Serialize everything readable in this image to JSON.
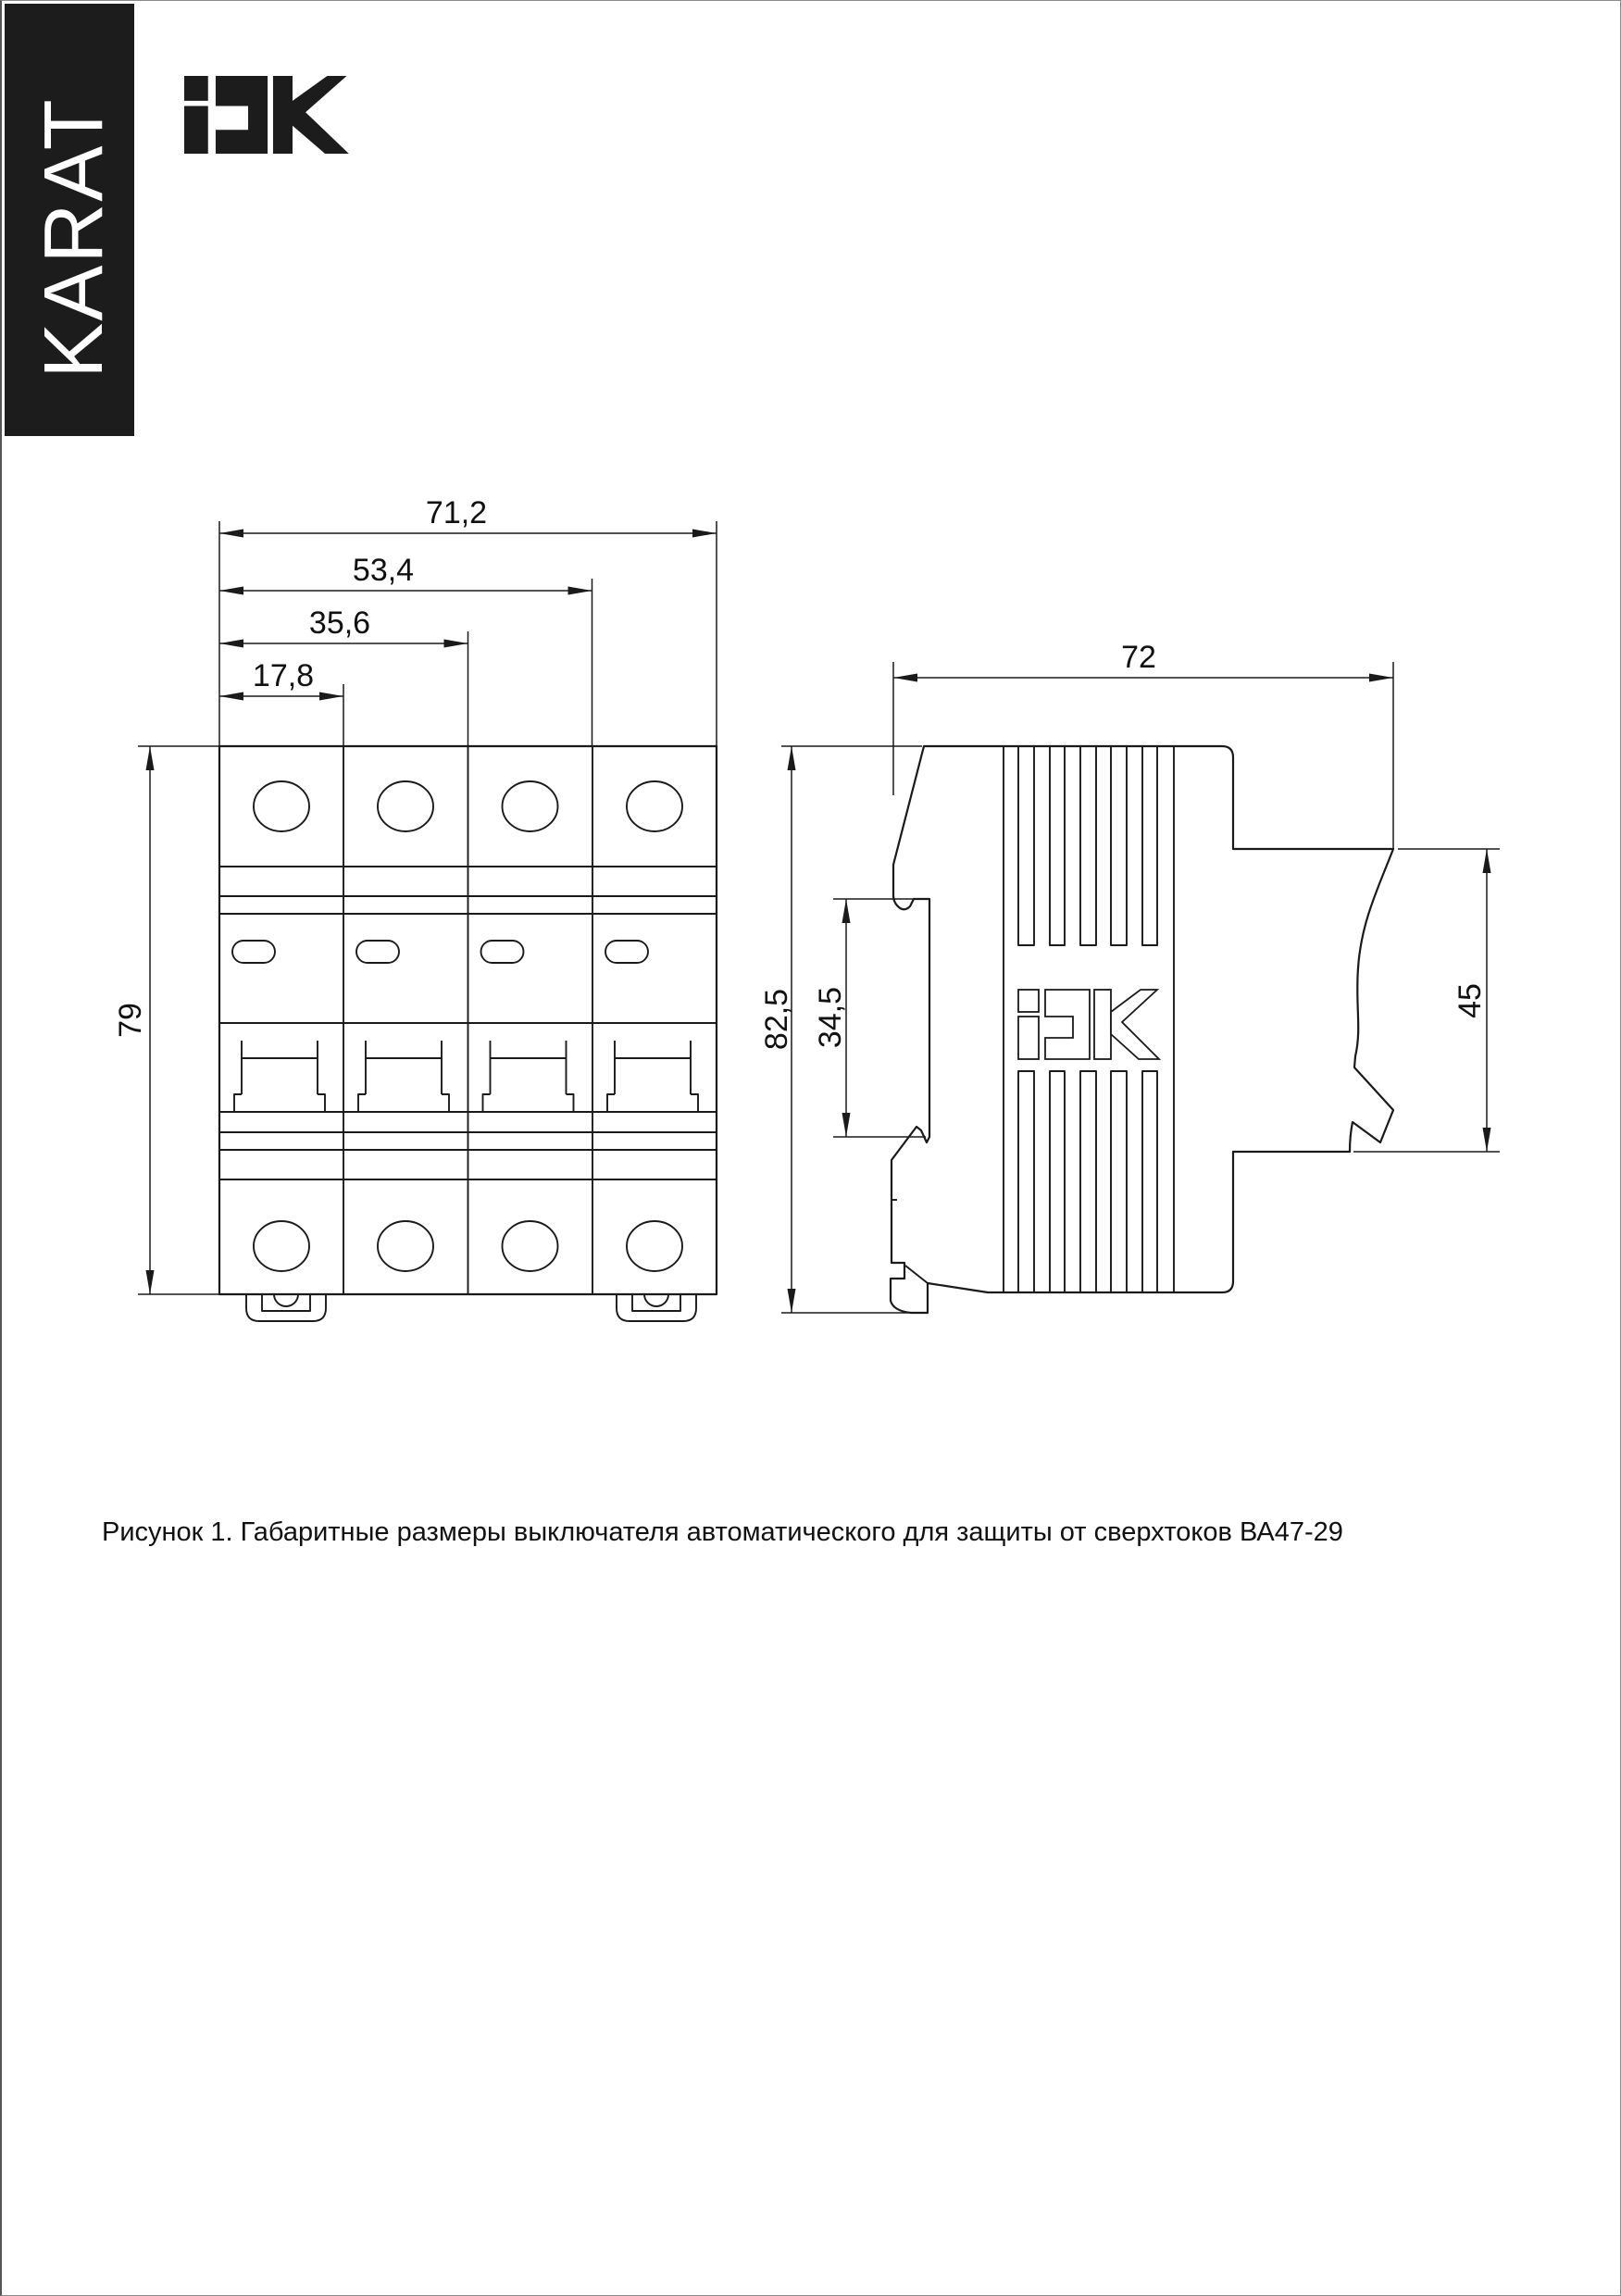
{
  "page": {
    "background": "#ffffff",
    "border_color": "#8a8a8a",
    "line_color": "#1a1a1a"
  },
  "brand": {
    "text": "KARAT",
    "bg": "#1c1c1c",
    "color": "#ffffff"
  },
  "logo": {
    "name": "IEK",
    "color": "#1c1c1c"
  },
  "figure": {
    "caption": "Рисунок 1. Габаритные размеры выключателя автоматического для защиты от сверхтоков ВА47-29",
    "front_view": {
      "modules": 4,
      "dim_width_total": "71,2",
      "dim_width_3mod": "53,4",
      "dim_width_2mod": "35,6",
      "dim_width_1mod": "17,8",
      "dim_height": "79"
    },
    "side_view": {
      "dim_depth": "72",
      "dim_height_total": "82,5",
      "dim_din_slot": "34,5",
      "dim_front_height": "45",
      "logo_text": "iEK"
    }
  }
}
